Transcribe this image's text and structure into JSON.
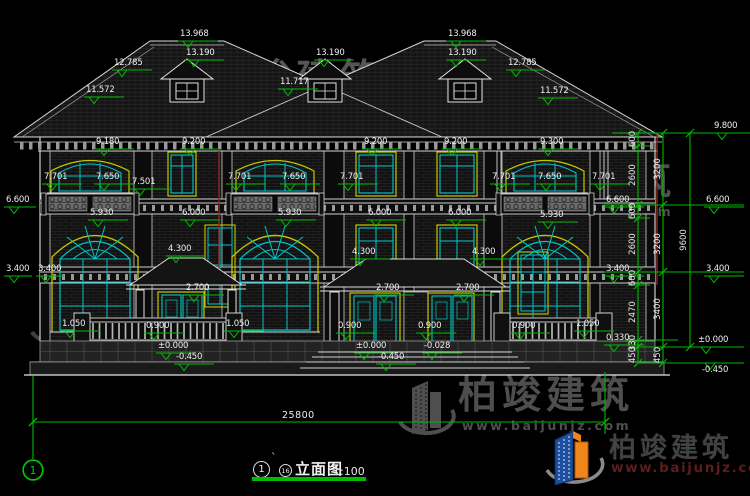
{
  "page": {
    "background": "#000000"
  },
  "colors": {
    "dimension_green": "#00bb00",
    "line_white": "#e0e0e0",
    "window_cyan": "#00c6c6",
    "trim_yellow": "#c6c600",
    "marker_red": "#8b2828",
    "watermark_gray": "#9b9b9b",
    "logo_blue": "#1d4f9e",
    "logo_orange": "#f08619"
  },
  "watermark": {
    "brand": "柏竣建筑",
    "url": "www.baijunjz.com"
  },
  "title_block": {
    "axis_bubble": "1",
    "mark": "`",
    "ref_bubble": "16",
    "title": "立面图",
    "scale": "1:100"
  },
  "axis": {
    "left_bubble": "1"
  },
  "dims": {
    "total_width": "25800"
  },
  "levels": {
    "annotations": [
      {
        "v": "13.968",
        "x": 178,
        "y": 41
      },
      {
        "v": "13.190",
        "x": 184,
        "y": 60
      },
      {
        "v": "13.190",
        "x": 314,
        "y": 60
      },
      {
        "v": "13.968",
        "x": 446,
        "y": 41
      },
      {
        "v": "13.190",
        "x": 446,
        "y": 60
      },
      {
        "v": "12.785",
        "x": 112,
        "y": 70
      },
      {
        "v": "12.785",
        "x": 506,
        "y": 70
      },
      {
        "v": "11.572",
        "x": 84,
        "y": 97
      },
      {
        "v": "11.717",
        "x": 278,
        "y": 89
      },
      {
        "v": "11.572",
        "x": 538,
        "y": 98
      },
      {
        "v": "9.180",
        "x": 94,
        "y": 149
      },
      {
        "v": "9.200",
        "x": 180,
        "y": 149
      },
      {
        "v": "9.200",
        "x": 362,
        "y": 149
      },
      {
        "v": "9.200",
        "x": 442,
        "y": 149
      },
      {
        "v": "9.300",
        "x": 538,
        "y": 149
      },
      {
        "v": "7.701",
        "x": 42,
        "y": 184
      },
      {
        "v": "7.650",
        "x": 94,
        "y": 184
      },
      {
        "v": "7.501",
        "x": 130,
        "y": 189
      },
      {
        "v": "7.701",
        "x": 226,
        "y": 184
      },
      {
        "v": "7.650",
        "x": 280,
        "y": 184
      },
      {
        "v": "7.701",
        "x": 338,
        "y": 184
      },
      {
        "v": "7.701",
        "x": 490,
        "y": 184
      },
      {
        "v": "7.650",
        "x": 536,
        "y": 184
      },
      {
        "v": "7.701",
        "x": 590,
        "y": 184
      },
      {
        "v": "6.600",
        "x": 4,
        "y": 207,
        "w": 32
      },
      {
        "v": "6.600",
        "x": 604,
        "y": 207
      },
      {
        "v": "5.930",
        "x": 88,
        "y": 220
      },
      {
        "v": "6.000",
        "x": 180,
        "y": 220
      },
      {
        "v": "5.930",
        "x": 276,
        "y": 220
      },
      {
        "v": "6.000",
        "x": 366,
        "y": 220
      },
      {
        "v": "6.000",
        "x": 446,
        "y": 220
      },
      {
        "v": "5.930",
        "x": 538,
        "y": 222
      },
      {
        "v": "4.300",
        "x": 166,
        "y": 256
      },
      {
        "v": "4.300",
        "x": 350,
        "y": 259
      },
      {
        "v": "4.300",
        "x": 470,
        "y": 259
      },
      {
        "v": "3.400",
        "x": 4,
        "y": 276,
        "w": 28
      },
      {
        "v": "3.400",
        "x": 36,
        "y": 276,
        "w": 28
      },
      {
        "v": "3.400",
        "x": 604,
        "y": 276
      },
      {
        "v": "2.700",
        "x": 184,
        "y": 295
      },
      {
        "v": "2.700",
        "x": 374,
        "y": 295
      },
      {
        "v": "2.700",
        "x": 454,
        "y": 295
      },
      {
        "v": "1.050",
        "x": 60,
        "y": 331
      },
      {
        "v": "1.050",
        "x": 224,
        "y": 331
      },
      {
        "v": "1.050",
        "x": 574,
        "y": 331
      },
      {
        "v": "0.900",
        "x": 144,
        "y": 333
      },
      {
        "v": "0.900",
        "x": 336,
        "y": 333
      },
      {
        "v": "0.900",
        "x": 416,
        "y": 333
      },
      {
        "v": "0.900",
        "x": 510,
        "y": 333
      },
      {
        "v": "0.330",
        "x": 604,
        "y": 345
      },
      {
        "v": "±0.000",
        "x": 156,
        "y": 353
      },
      {
        "v": "±0.000",
        "x": 354,
        "y": 353
      },
      {
        "v": "-0.028",
        "x": 422,
        "y": 353
      },
      {
        "v": "-0.450",
        "x": 174,
        "y": 364
      },
      {
        "v": "-0.450",
        "x": 376,
        "y": 364
      },
      {
        "v": "9.800",
        "x": 712,
        "y": 133
      },
      {
        "v": "6.600",
        "x": 704,
        "y": 207
      },
      {
        "v": "3.400",
        "x": 704,
        "y": 276
      },
      {
        "v": "±0.000",
        "x": 696,
        "y": 347
      },
      {
        "v": "-0.450",
        "x": 700,
        "y": 363,
        "tb": 1
      }
    ]
  },
  "chain": {
    "col1": [
      "600",
      "2600",
      "600",
      "2600",
      "600",
      "2470",
      "330",
      "450"
    ],
    "col2": [
      "3200",
      "3200",
      "3400",
      "450"
    ],
    "col3": [
      "9600"
    ]
  }
}
